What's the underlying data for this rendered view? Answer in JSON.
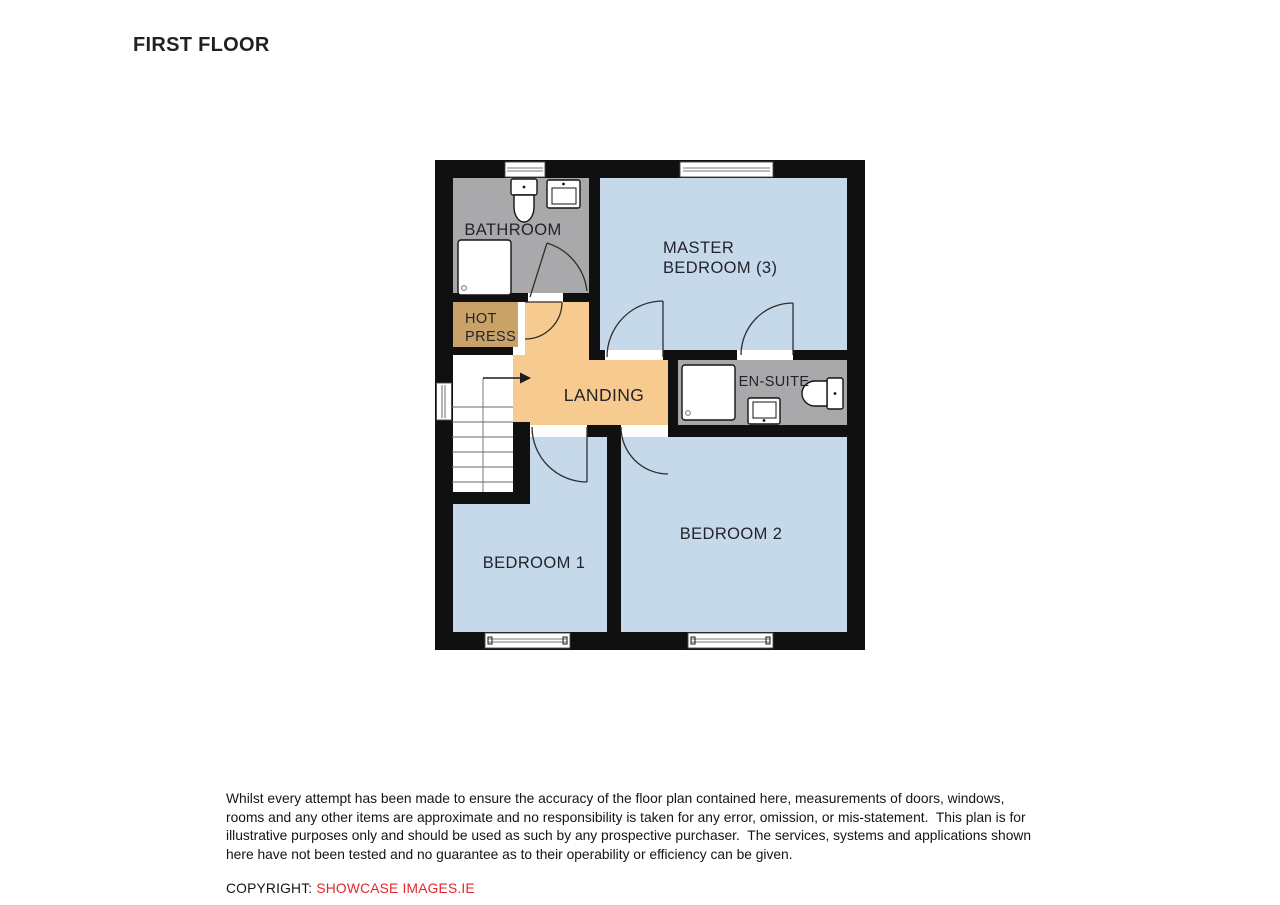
{
  "title": "FIRST FLOOR",
  "plan": {
    "colors": {
      "wall": "#101010",
      "room_blue": "#c6d9ea",
      "landing_orange": "#f7ca90",
      "hot_press_tan": "#c9a267",
      "wet_room_gray": "#a9a9ab"
    },
    "rooms": {
      "bathroom": {
        "label": "BATHROOM"
      },
      "master_bedroom": {
        "line1": "MASTER",
        "line2": "BEDROOM (3)"
      },
      "hot_press": {
        "line1": "HOT",
        "line2": "PRESS"
      },
      "landing": {
        "label": "LANDING"
      },
      "en_suite": {
        "label": "EN-SUITE"
      },
      "bedroom_1": {
        "label": "BEDROOM 1"
      },
      "bedroom_2": {
        "label": "BEDROOM 2"
      }
    }
  },
  "disclaimer": {
    "lines": [
      "Whilst every attempt has been made to ensure the accuracy of the floor plan contained here, measurements of doors, windows,",
      "rooms and any other items are approximate and no responsibility is taken for any error, omission, or mis-statement.  This plan is for",
      "illustrative purposes only and should be used as such by any prospective purchaser.  The services, systems and applications shown",
      "here have not been tested and no guarantee as to their operability or efficiency can be given."
    ]
  },
  "copyright": {
    "label": "COPYRIGHT: ",
    "source": "SHOWCASE IMAGES.IE",
    "source_color": "#e5252b"
  }
}
